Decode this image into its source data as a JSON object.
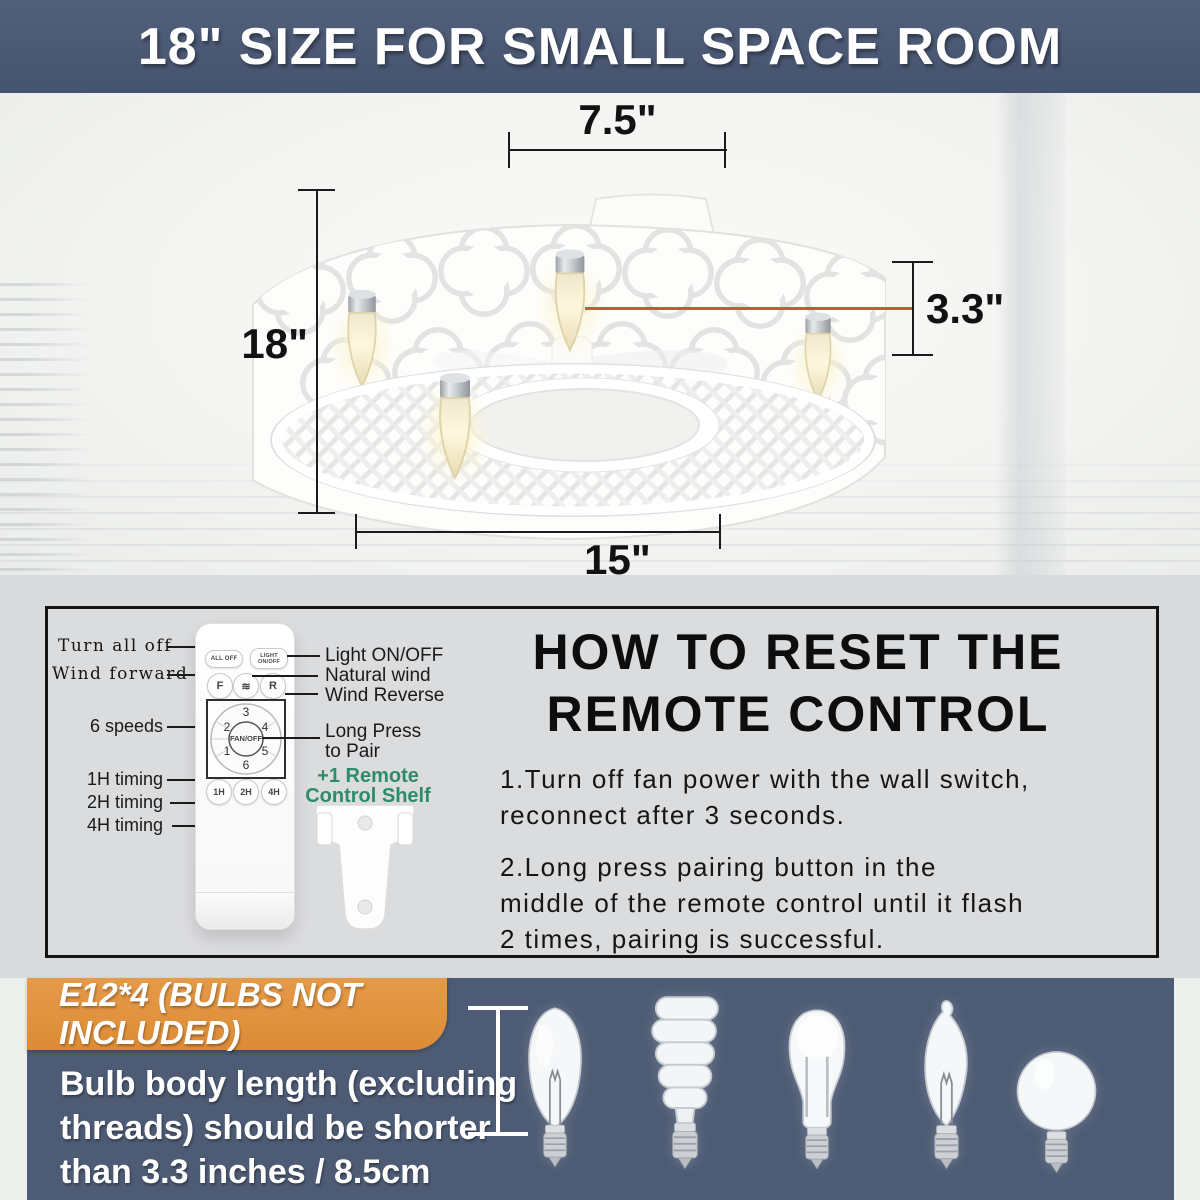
{
  "banner": {
    "title": "18\" SIZE FOR SMALL SPACE ROOM"
  },
  "fan_dimensions": {
    "top_width": "7.5\"",
    "height": "18\"",
    "bulb_height": "3.3\"",
    "bottom_width": "15\""
  },
  "remote_section": {
    "labels_left": [
      "Turn all off",
      "Wind forward",
      "6 speeds",
      "1H timing",
      "2H timing",
      "4H timing"
    ],
    "labels_right": [
      "Light ON/OFF",
      "Natural wind",
      "Wind Reverse"
    ],
    "pair_line1": "Long Press",
    "pair_line2": "to Pair",
    "shelf_line1": "+1 Remote",
    "shelf_line2": "Control Shelf",
    "buttons": {
      "all_off": "ALL OFF",
      "light_line1": "LIGHT",
      "light_line2": "ON/OFF",
      "forward": "F",
      "natural_wind_icon": "≋",
      "reverse": "R",
      "fan_off": "FAN/OFF",
      "speeds": [
        "1",
        "2",
        "3",
        "4",
        "5",
        "6"
      ],
      "timers": [
        "1H",
        "2H",
        "4H"
      ]
    }
  },
  "reset_instructions": {
    "title_line1": "HOW TO RESET THE",
    "title_line2": "REMOTE CONTROL",
    "step1_lines": [
      "1.Turn off fan power with the wall switch,",
      "reconnect after 3 seconds."
    ],
    "step2_lines": [
      "2.Long press pairing button in the",
      "middle of the remote control until it flash",
      "2 times, pairing is successful."
    ]
  },
  "bulb_section": {
    "banner": "E12*4 (BULBS NOT INCLUDED)",
    "note_line1": "Bulb body length (excluding",
    "note_line2": "threads) should be shorter",
    "note_line3": "than 3.3 inches / 8.5cm",
    "bulb_types": [
      "incandescent",
      "spiral-cfl",
      "led",
      "flame-tip",
      "globe"
    ]
  },
  "colors": {
    "header_bg": "#4a5874",
    "panel_bg": "#4d5b75",
    "accent_orange": "#e2923f",
    "leader_red": "#c8573c",
    "shelf_green": "#2e8b6b"
  }
}
